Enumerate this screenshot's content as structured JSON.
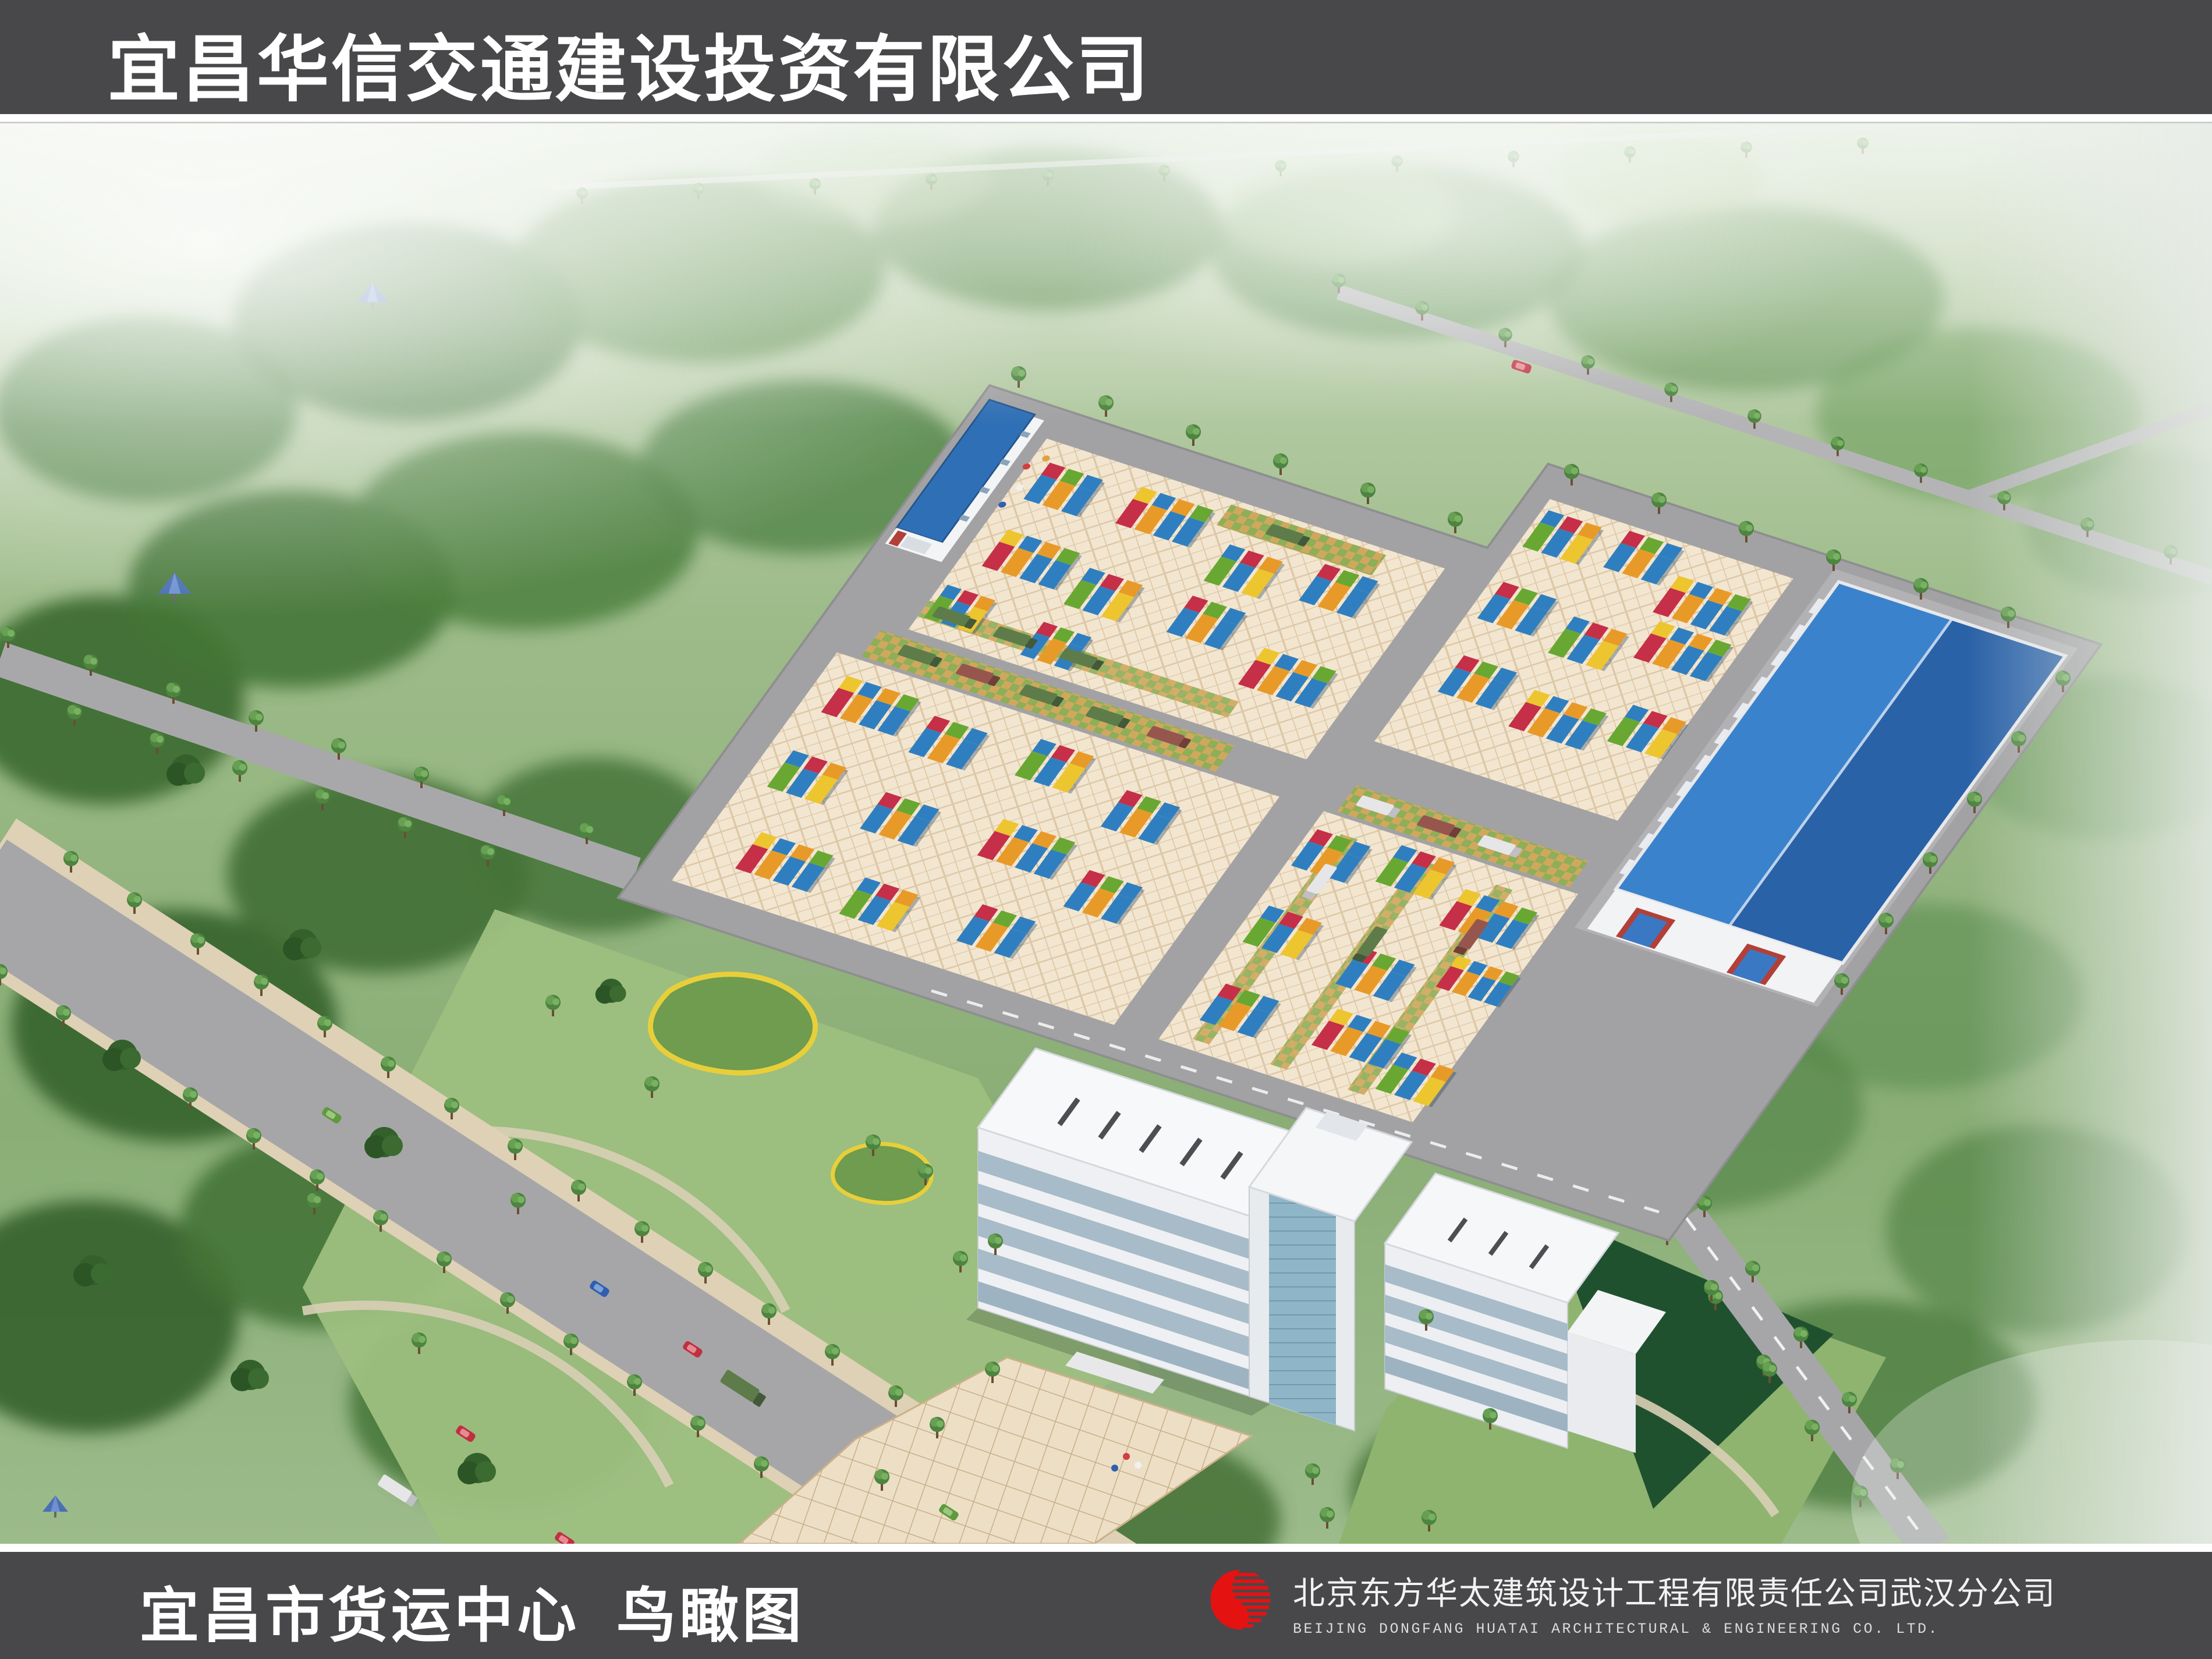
{
  "header": {
    "title": "宜昌华信交通建设投资有限公司"
  },
  "footer": {
    "caption": "宜昌市货运中心  鸟瞰图",
    "company_cn": "北京东方华太建筑设计工程有限责任公司武汉分公司",
    "company_en": "BEIJING DONGFANG HUATAI ARCHITECTURAL & ENGINEERING CO. LTD."
  },
  "scene": {
    "type": "aerial-architectural-rendering",
    "subject": "Bird's-eye 3D rendering of the Yichang City Freight Center: paved container yard with four storage zones, gate house with blue roof, large blue-roofed warehouse, white multi-storey office building with entry plaza, tree-lined roads and wooded parkland surroundings",
    "palette": {
      "banner_bg": "#48484b",
      "banner_text": "#ffffff",
      "logo_red": "#e51212",
      "road_gray": "#a6a6a8",
      "yard_paving": "#f3e6d0",
      "warehouse_roof_blue": "#2f6fb5",
      "container_blue": "#2f7fc0",
      "container_red": "#c52f48",
      "container_orange": "#e89a28",
      "container_green": "#68a832",
      "container_yellow": "#edc52f",
      "foliage_green": "#4c7c3d"
    }
  }
}
